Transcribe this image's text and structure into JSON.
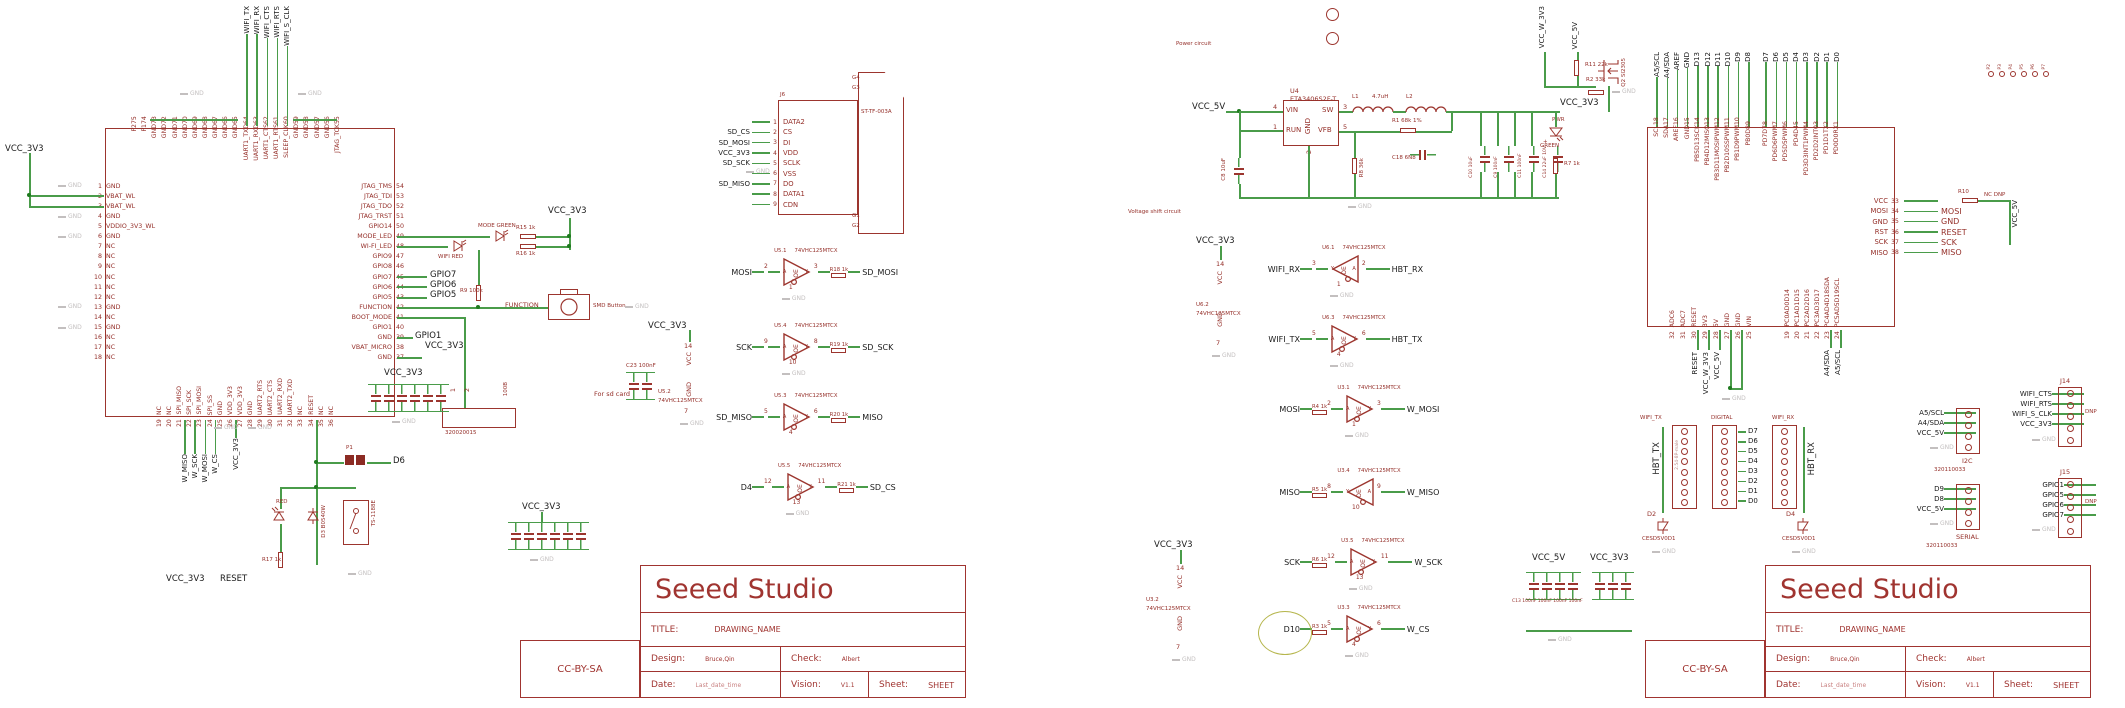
{
  "misc": {
    "gnd": "GND",
    "oe": "OE",
    "a": "A",
    "y": "Y"
  },
  "titleblock": {
    "company": "Seeed Studio",
    "title_label": "TITLE:",
    "title": "DRAWING_NAME",
    "design_label": "Design:",
    "design": "Bruce,Qin",
    "check_label": "Check:",
    "check": "Albert",
    "date_label": "Date:",
    "date": "Last_date_time",
    "vision_label": "Vision:",
    "vision": "V1.1",
    "sheet_label": "Sheet:",
    "sheet": "SHEET",
    "license": "CC-BY-SA"
  },
  "left": {
    "ic": {
      "left_pins": [
        {
          "n": "1",
          "name": "GND"
        },
        {
          "n": "2",
          "name": "VBAT_WL"
        },
        {
          "n": "3",
          "name": "VBAT_WL"
        },
        {
          "n": "4",
          "name": "GND"
        },
        {
          "n": "5",
          "name": "VDDIO_3V3_WL"
        },
        {
          "n": "6",
          "name": "GND"
        },
        {
          "n": "7",
          "name": "NC"
        },
        {
          "n": "8",
          "name": "NC"
        },
        {
          "n": "9",
          "name": "NC"
        },
        {
          "n": "10",
          "name": "NC"
        },
        {
          "n": "11",
          "name": "NC"
        },
        {
          "n": "12",
          "name": "NC"
        },
        {
          "n": "13",
          "name": "GND"
        },
        {
          "n": "14",
          "name": "NC"
        },
        {
          "n": "15",
          "name": "GND"
        },
        {
          "n": "16",
          "name": "NC"
        },
        {
          "n": "17",
          "name": "NC"
        },
        {
          "n": "18",
          "name": "NC"
        }
      ],
      "right_pins": [
        {
          "n": "54",
          "name": "JTAG_TMS"
        },
        {
          "n": "53",
          "name": "JTAG_TDI"
        },
        {
          "n": "52",
          "name": "JTAG_TDO"
        },
        {
          "n": "51",
          "name": "JTAG_TRST"
        },
        {
          "n": "50",
          "name": "GPIO14"
        },
        {
          "n": "49",
          "name": "MODE_LED"
        },
        {
          "n": "48",
          "name": "WI-FI_LED"
        },
        {
          "n": "47",
          "name": "GPIO9"
        },
        {
          "n": "46",
          "name": "GPIO8"
        },
        {
          "n": "45",
          "name": "GPIO7"
        },
        {
          "n": "44",
          "name": "GPIO6"
        },
        {
          "n": "43",
          "name": "GPIO5"
        },
        {
          "n": "42",
          "name": "FUNCTION"
        },
        {
          "n": "41",
          "name": "BOOT_MODE"
        },
        {
          "n": "40",
          "name": "GPIO1"
        },
        {
          "n": "39",
          "name": "GND"
        },
        {
          "n": "38",
          "name": "VBAT_MICRO"
        },
        {
          "n": "37",
          "name": "GND"
        }
      ],
      "top_pins": [
        {
          "n": "75",
          "name": "P2"
        },
        {
          "n": "74",
          "name": "P1"
        },
        {
          "n": "73",
          "name": "GND"
        },
        {
          "n": "72",
          "name": "GND"
        },
        {
          "n": "71",
          "name": "GND"
        },
        {
          "n": "70",
          "name": "GND"
        },
        {
          "n": "69",
          "name": "GND"
        },
        {
          "n": "68",
          "name": "GND"
        },
        {
          "n": "67",
          "name": "GND"
        },
        {
          "n": "66",
          "name": "GND"
        },
        {
          "n": "65",
          "name": "GND"
        },
        {
          "n": "64",
          "name": "UART1_TXD"
        },
        {
          "n": "63",
          "name": "UART1_RXD"
        },
        {
          "n": "62",
          "name": "UART1_CTS"
        },
        {
          "n": "61",
          "name": "UART1_RTS"
        },
        {
          "n": "60",
          "name": "SLEEP_CLK"
        },
        {
          "n": "59",
          "name": "GND"
        },
        {
          "n": "58",
          "name": "GND"
        },
        {
          "n": "57",
          "name": "GND"
        },
        {
          "n": "56",
          "name": "GND"
        },
        {
          "n": "55",
          "name": "JTAG_TCK"
        }
      ],
      "bottom_pins": [
        {
          "n": "19",
          "name": "NC"
        },
        {
          "n": "20",
          "name": "NC"
        },
        {
          "n": "21",
          "name": "SPI_MISO"
        },
        {
          "n": "22",
          "name": "SPI_SCK"
        },
        {
          "n": "23",
          "name": "SPI_MOSI"
        },
        {
          "n": "24",
          "name": "SPI_SS"
        },
        {
          "n": "25",
          "name": "GND"
        },
        {
          "n": "26",
          "name": "VDD_3V3"
        },
        {
          "n": "27",
          "name": "VDD_3V3"
        },
        {
          "n": "28",
          "name": "GND"
        },
        {
          "n": "29",
          "name": "UART2_RTS"
        },
        {
          "n": "30",
          "name": "UART2_CTS"
        },
        {
          "n": "31",
          "name": "UART2_RXD"
        },
        {
          "n": "32",
          "name": "UART2_TXD"
        },
        {
          "n": "33",
          "name": "NC"
        },
        {
          "n": "34",
          "name": "RESET"
        },
        {
          "n": "35",
          "name": "NC"
        },
        {
          "n": "36",
          "name": "NC"
        }
      ],
      "top_nets": [
        "WIFI_TX",
        "WIFI_RX",
        "WIFI_CTS",
        "WIFI_RTS",
        "WIFI_S_CLK"
      ],
      "bottom_nets": [
        "W_MISO",
        "W_SCK",
        "W_MOSI",
        "W_CS"
      ],
      "bottom_power": "VCC_3V3",
      "left_power": "VCC_3V3",
      "right_nets": [
        "GPIO7",
        "GPIO6",
        "GPIO5"
      ],
      "gpio1_net": "GPIO1",
      "vbat_net": "VCC_3V3"
    },
    "leds": {
      "row1_name": "MODE GREEN",
      "row1_res": "R15  1k",
      "row2_name": "WIFI RED",
      "row2_res": "R16  1k",
      "power": "VCC_3V3"
    },
    "func": {
      "res": "R9  100k",
      "btn_net": "FUNCTION",
      "btn_label": "SMD Button"
    },
    "conn": {
      "pin1": "1",
      "pin2": "2",
      "value": "100B",
      "part": "320020015"
    },
    "reset": {
      "jumper": "P1",
      "net_d6": "D6",
      "led": "RED",
      "res": "R17  1k",
      "diode": "D3  B0540W",
      "sw": "TS-1188E",
      "net1": "VCC_3V3",
      "net2": "RESET"
    },
    "bank1_power": "VCC_3V3",
    "bank2_power": "VCC_3V3",
    "sdsup": {
      "power": "VCC_3V3",
      "cap": "C23 100nF",
      "ref": "U5.2",
      "part": "74VHC125MTCX",
      "vcc": "VCC",
      "vcc_n": "14",
      "gnd": "GND",
      "gnd_n": "7",
      "note": "For sd card"
    },
    "sd": {
      "ref": "J6",
      "part": "ST-TF-003A",
      "rows": [
        {
          "net": "",
          "n": "1",
          "name": "DATA2"
        },
        {
          "net": "SD_CS",
          "n": "2",
          "name": "CS"
        },
        {
          "net": "SD_MOSI",
          "n": "3",
          "name": "DI"
        },
        {
          "net": "VCC_3V3",
          "n": "4",
          "name": "VDD"
        },
        {
          "net": "SD_SCK",
          "n": "5",
          "name": "SCLK"
        },
        {
          "net": "",
          "n": "6",
          "name": "VSS"
        },
        {
          "net": "SD_MISO",
          "n": "7",
          "name": "DO"
        },
        {
          "net": "",
          "n": "8",
          "name": "DATA1"
        },
        {
          "net": "",
          "n": "9",
          "name": "CDN"
        }
      ],
      "shield_top": [
        "G4",
        "G3"
      ],
      "shield_bot": [
        "G1",
        "G2"
      ]
    },
    "buffers": [
      {
        "ref": "U5.1",
        "part": "74VHC125MTCX",
        "l": "MOSI",
        "lr": "",
        "lp": "2",
        "rp": "3",
        "rr": "R18  1k",
        "r": "SD_MOSI",
        "dir": "right",
        "oe": "1",
        "g": "1",
        "circle": ""
      },
      {
        "ref": "U5.4",
        "part": "74VHC125MTCX",
        "l": "SCK",
        "lr": "",
        "lp": "9",
        "rp": "8",
        "rr": "R19  1k",
        "r": "SD_SCK",
        "dir": "right",
        "oe": "10",
        "g": "1",
        "circle": ""
      },
      {
        "ref": "U5.3",
        "part": "74VHC125MTCX",
        "l": "SD_MISO",
        "lr": "",
        "lp": "5",
        "rp": "6",
        "rr": "R20  1k",
        "r": "MISO",
        "dir": "right",
        "oe": "4",
        "g": "",
        "circle": ""
      },
      {
        "ref": "U5.5",
        "part": "74VHC125MTCX",
        "l": "D4",
        "lr": "",
        "lp": "12",
        "rp": "11",
        "rr": "R21  1k",
        "r": "SD_CS",
        "dir": "right",
        "oe": "13",
        "g": "1",
        "circle": ""
      }
    ]
  },
  "right": {
    "power": {
      "label": "Power circuit",
      "in_net": "VCC_5V",
      "ref": "U4",
      "part": "ETA3406S2F-T",
      "p_vin": "VIN",
      "n_vin": "4",
      "p_run": "RUN",
      "n_run": "1",
      "p_gnd": "GND",
      "n_gnd": "2",
      "p_sw": "SW",
      "n_sw": "3",
      "p_vfb": "VFB",
      "n_vfb": "5",
      "l1": "L1",
      "l1v": "4.7uH",
      "l2": "L2",
      "c8": "C8 10uF",
      "r1": "R1 68k 1%",
      "c18": "C18 6N8",
      "r8": "R8 36k",
      "c10": "C10 10uF",
      "c9": "C9 100nF",
      "c11": "C11 100nF",
      "c14": "C14 22uF 10V",
      "plus": "+",
      "pwr": "PWR",
      "pwr_color": "GREEN",
      "r7": "R7 1k",
      "out_net": "VCC_3V3"
    },
    "gate": {
      "net1": "VCC_W_3V3",
      "net2": "VCC_5V",
      "r11": "R11 22k",
      "r2": "R2 33k",
      "q": "Q2 SI2305",
      "out": "VCC_3V3"
    },
    "shift_label": "Voltage shift circuit",
    "u62": {
      "power": "VCC_3V3",
      "ref": "U6.2",
      "part": "74VHC125MTCX",
      "vcc": "VCC",
      "vcc_n": "14",
      "gnd": "GND",
      "gnd_n": "7"
    },
    "u32": {
      "power": "VCC_3V3",
      "ref": "U3.2",
      "part": "74VHC125MTCX",
      "vcc": "VCC",
      "vcc_n": "14",
      "gnd": "GND",
      "gnd_n": "7"
    },
    "buffers": [
      {
        "ref": "U6.1",
        "part": "74VHC125MTCX",
        "l": "WIFI_RX",
        "lr": "",
        "lp": "3",
        "rp": "2",
        "rr": "",
        "r": "HBT_RX",
        "dir": "left",
        "oe": "1",
        "g": "1",
        "circle": ""
      },
      {
        "ref": "U6.3",
        "part": "74VHC125MTCX",
        "l": "WIFI_TX",
        "lr": "",
        "lp": "5",
        "rp": "6",
        "rr": "",
        "r": "HBT_TX",
        "dir": "right",
        "oe": "4",
        "g": "1",
        "circle": ""
      },
      {
        "ref": "U3.1",
        "part": "74VHC125MTCX",
        "l": "MOSI",
        "lr": "R4  1k",
        "lp": "2",
        "rp": "3",
        "rr": "",
        "r": "W_MOSI",
        "dir": "right",
        "oe": "1",
        "g": "1",
        "circle": ""
      },
      {
        "ref": "U3.4",
        "part": "74VHC125MTCX",
        "l": "MISO",
        "lr": "R5  1k",
        "lp": "8",
        "rp": "9",
        "rr": "",
        "r": "W_MISO",
        "dir": "left",
        "oe": "10",
        "g": "",
        "circle": ""
      },
      {
        "ref": "U3.5",
        "part": "74VHC125MTCX",
        "l": "SCK",
        "lr": "R6  1k",
        "lp": "12",
        "rp": "11",
        "rr": "",
        "r": "W_SCK",
        "dir": "right",
        "oe": "13",
        "g": "1",
        "circle": ""
      },
      {
        "ref": "U3.3",
        "part": "74VHC125MTCX",
        "l": "D10",
        "lr": "R3  1k",
        "lp": "5",
        "rp": "6",
        "rr": "",
        "r": "W_CS",
        "dir": "right",
        "oe": "4",
        "g": "1",
        "circle": "yes"
      }
    ],
    "socket": {
      "top_pins_a": [
        {
          "n": "18",
          "name": "SCL"
        },
        {
          "n": "17",
          "name": "SDA"
        },
        {
          "n": "16",
          "name": "AREF"
        },
        {
          "n": "15",
          "name": "GND"
        },
        {
          "n": "14",
          "name": "PB5D13SCK"
        },
        {
          "n": "13",
          "name": "PB4D12MISO"
        },
        {
          "n": "12",
          "name": "PB3D11MOSIPWM"
        },
        {
          "n": "11",
          "name": "PB2D10SSPWM"
        },
        {
          "n": "10",
          "name": "PB1D9PWM"
        },
        {
          "n": "9",
          "name": "PB0D8"
        }
      ],
      "top_pins_b": [
        {
          "n": "8",
          "name": "PD7D7"
        },
        {
          "n": "7",
          "name": "PD6D6PWM"
        },
        {
          "n": "6",
          "name": "PD5D5PWM"
        },
        {
          "n": "5",
          "name": "PD4D4"
        },
        {
          "n": "4",
          "name": "PD3D3INT1PWM"
        },
        {
          "n": "3",
          "name": "PD2D2INT0"
        },
        {
          "n": "2",
          "name": "PD1D1TX"
        },
        {
          "n": "1",
          "name": "PD0D0RX"
        }
      ],
      "top_nets_a": [
        "A5/SCL",
        "A4/SDA",
        "AREF",
        "GND",
        "D13",
        "D12",
        "D11",
        "D10",
        "D9",
        "D8"
      ],
      "top_nets_b": [
        "D7",
        "D6",
        "D5",
        "D4",
        "D3",
        "D2",
        "D1",
        "D0"
      ],
      "right_rows": [
        {
          "n": "33",
          "name": "VCC",
          "net": ""
        },
        {
          "n": "34",
          "name": "MOSI",
          "net": "MOSI"
        },
        {
          "n": "35",
          "name": "GND",
          "net": "GND"
        },
        {
          "n": "36",
          "name": "RST",
          "net": "RESET"
        },
        {
          "n": "37",
          "name": "SCK",
          "net": "SCK"
        },
        {
          "n": "38",
          "name": "MISO",
          "net": "MISO"
        }
      ],
      "r10": "R10",
      "r10_note": "NC DNP",
      "r10_net": "VCC_5V",
      "bottom_pins_a": [
        {
          "n": "32",
          "name": "ADC6"
        },
        {
          "n": "31",
          "name": "ADC7"
        },
        {
          "n": "30",
          "name": "RESET"
        },
        {
          "n": "29",
          "name": "3V3"
        },
        {
          "n": "28",
          "name": "5V"
        },
        {
          "n": "27",
          "name": "GND"
        },
        {
          "n": "26",
          "name": "GND"
        },
        {
          "n": "25",
          "name": "VIN"
        }
      ],
      "bottom_nets_a": [
        "RESET",
        "VCC_W_3V3",
        "VCC_5V"
      ],
      "bottom_pins_b": [
        {
          "n": "19",
          "name": "PC0AD0D14"
        },
        {
          "n": "20",
          "name": "PC1AD1D15"
        },
        {
          "n": "21",
          "name": "PC2AD2D16"
        },
        {
          "n": "22",
          "name": "PC3AD3D17"
        },
        {
          "n": "23",
          "name": "PC4AD4D18SDA"
        },
        {
          "n": "24",
          "name": "PC5AD5D19SCL"
        }
      ],
      "bottom_nets_b": [
        "A4/SDA",
        "A5/SCL"
      ],
      "holes": [
        "P2",
        "P3",
        "P4",
        "P5",
        "P6",
        "P7"
      ]
    },
    "headers": {
      "tx_label": "WIFI_TX",
      "tx_net": "HBT_TX",
      "tx_d": "D2",
      "rx_label": "WIFI_RX",
      "rx_net": "HBT_RX",
      "rx_d": "D4",
      "dig_label": "DIGITAL",
      "dig_nets": [
        "D7",
        "D6",
        "D5",
        "D4",
        "D3",
        "D2",
        "D1",
        "D0"
      ],
      "dpart": "CESD5V0D1",
      "hpart": "2.54-8P-male"
    },
    "conns": {
      "i2c": {
        "nets": [
          "A5/SCL",
          "A4/SDA",
          "VCC_5V"
        ],
        "label": "I2C",
        "part": "320110033"
      },
      "j14": {
        "ref": "J14",
        "nets": [
          "WIFI_CTS",
          "WIFI_RTS",
          "WIFI_S_CLK",
          "VCC_3V3"
        ],
        "dnp": "DNP"
      },
      "serial": {
        "nets": [
          "D9",
          "D8",
          "VCC_5V"
        ],
        "label": "SERIAL",
        "part": "320110033"
      },
      "j15": {
        "ref": "J15",
        "nets": [
          "GPIO1",
          "GPIO5",
          "GPIO6",
          "GPIO7"
        ],
        "dnp": "DNP"
      }
    },
    "banks": {
      "a": "VCC_5V",
      "b": "VCC_3V3",
      "vals": "C13 100nF 100nF 100nF 100nF"
    }
  }
}
